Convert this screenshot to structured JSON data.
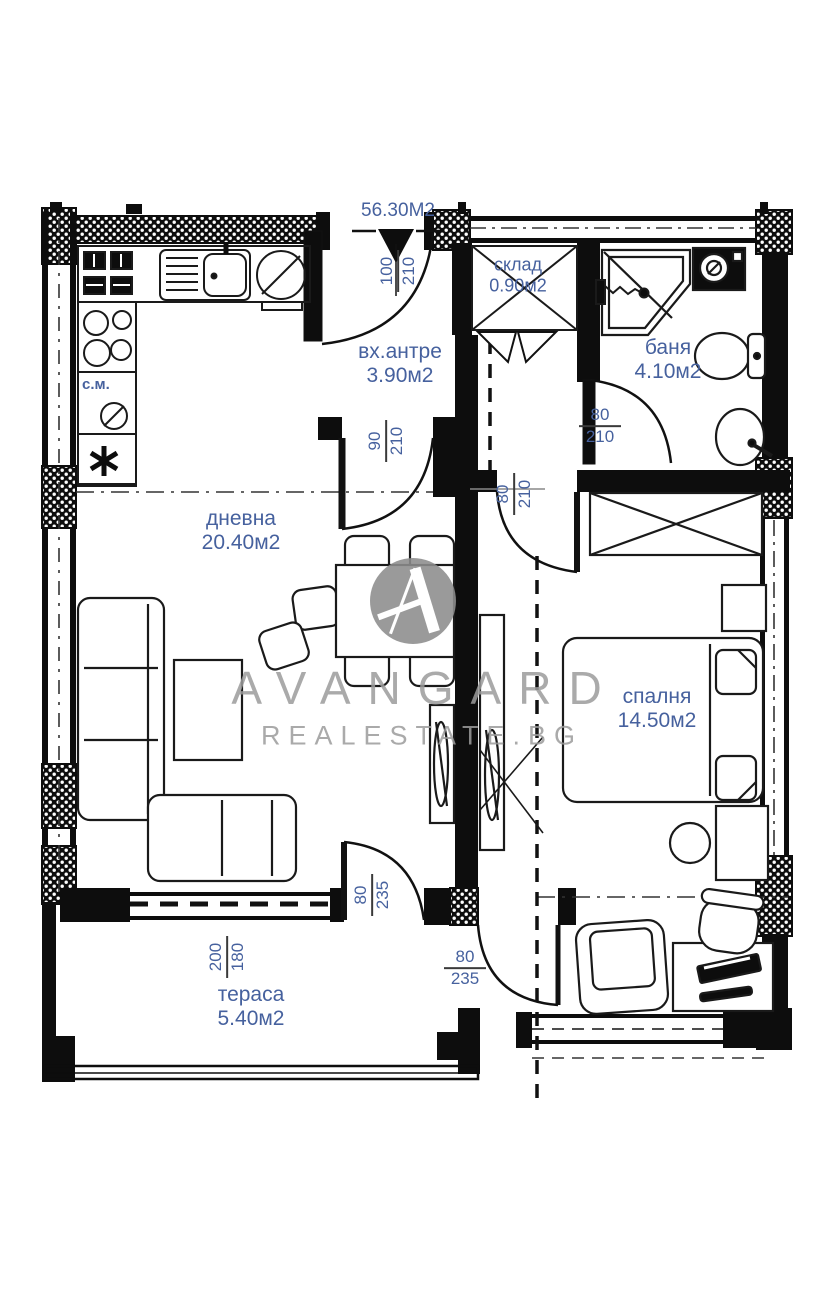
{
  "colors": {
    "wall": "#0d0d0d",
    "label_blue": "#46619e",
    "watermark_gray": "#9c9c9c",
    "dim_bar": "#3a3a3a"
  },
  "header": {
    "total_area": "56.30М2"
  },
  "watermark": {
    "brand": "AVANGARD",
    "site": "REALESTATE.BG"
  },
  "rooms": {
    "entry": {
      "name": "вх.антре",
      "area": "3.90м2"
    },
    "storage": {
      "name": "склад",
      "area": "0.90м2"
    },
    "bath": {
      "name": "баня",
      "area": "4.10м2"
    },
    "living": {
      "name": "дневна",
      "area": "20.40м2"
    },
    "bedroom": {
      "name": "спалня",
      "area": "14.50м2"
    },
    "terrace": {
      "name": "тераса",
      "area": "5.40м2"
    }
  },
  "dimensions": {
    "entry_door": {
      "w": "100",
      "h": "210"
    },
    "living_door": {
      "w": "90",
      "h": "210"
    },
    "bedroom_door": {
      "w": "80",
      "h": "210"
    },
    "bath_door": {
      "w": "80",
      "h": "210"
    },
    "terrace_door": {
      "w": "80",
      "h": "235"
    },
    "passage_door": {
      "w": "80",
      "h": "235"
    },
    "terrace_window": {
      "w": "200",
      "h": "180"
    }
  },
  "appliances": {
    "washing_machine": "с.м."
  }
}
